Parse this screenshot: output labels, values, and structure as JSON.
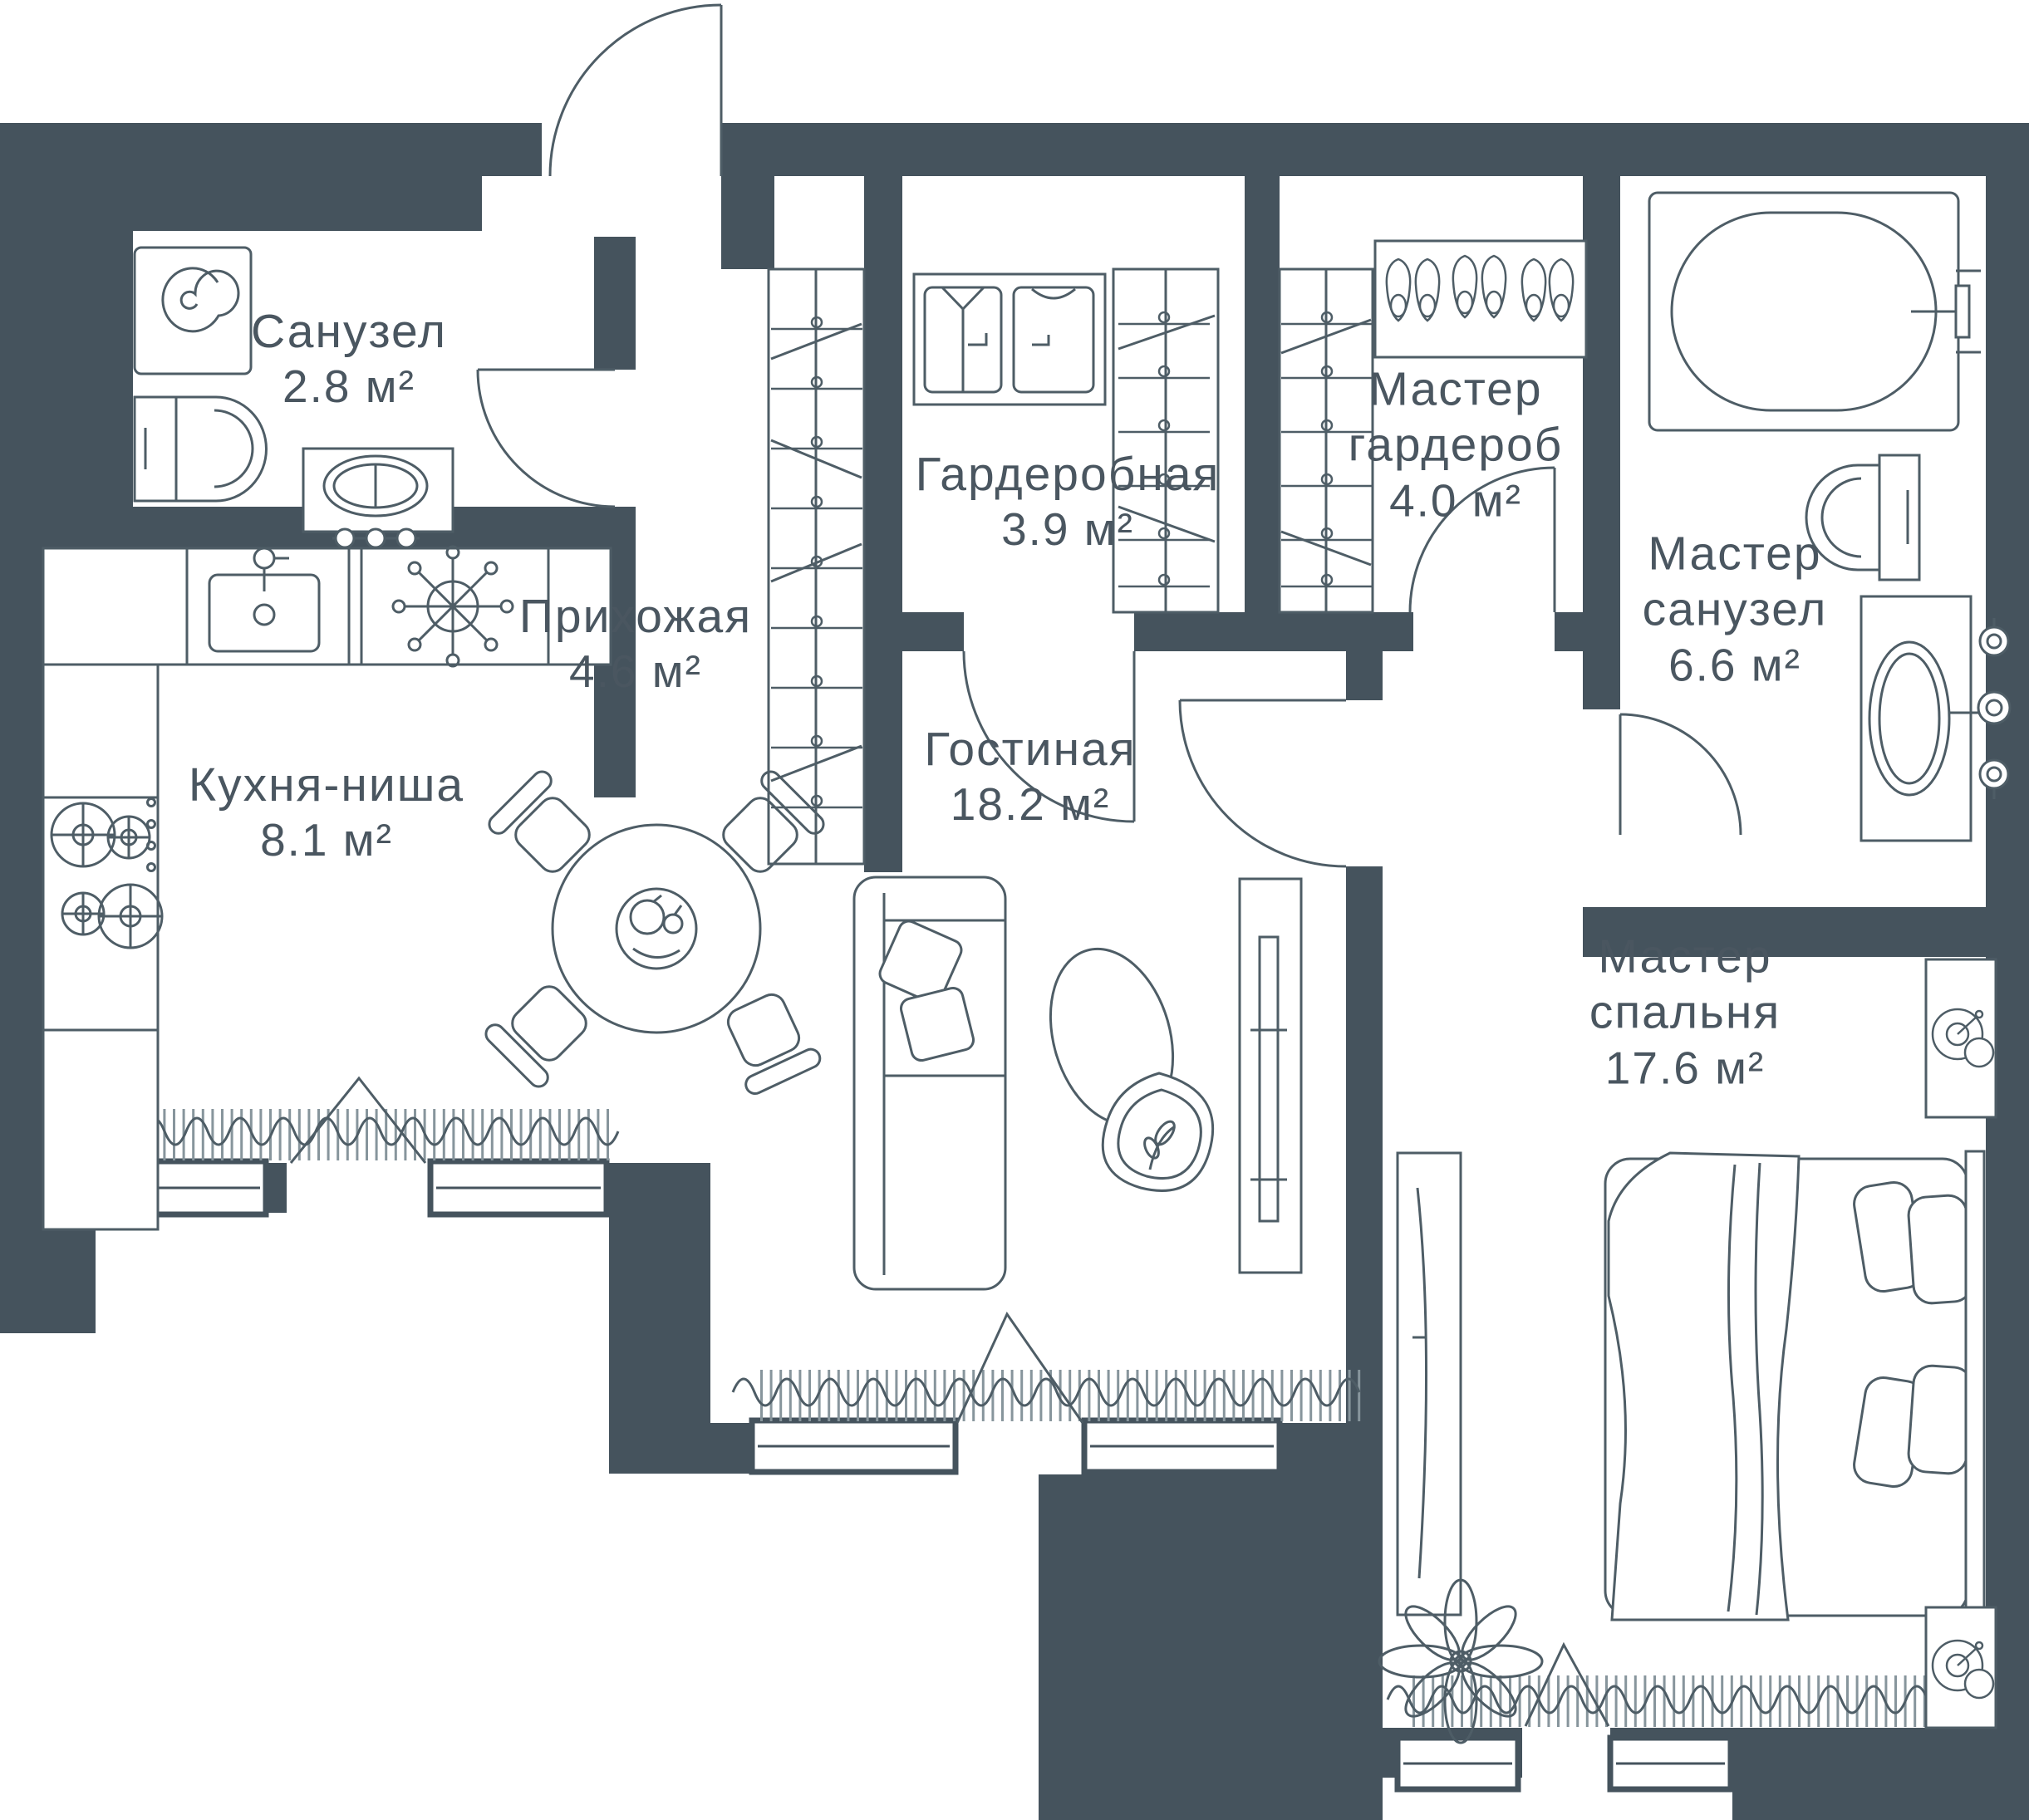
{
  "plan_type": "apartment floor plan",
  "rooms": [
    {
      "name": "Санузел",
      "area": "2.8 м²"
    },
    {
      "name": "Прихожая",
      "area": "4.6 м²"
    },
    {
      "name": "Гардеробная",
      "area": "3.9 м²"
    },
    {
      "name": "Мастер гардероб",
      "area": "4.0 м²"
    },
    {
      "name": "Мастер санузел",
      "area": "6.6 м²"
    },
    {
      "name": "Кухня-ниша",
      "area": "8.1 м²"
    },
    {
      "name": "Гостиная",
      "area": "18.2 м²"
    },
    {
      "name": "Мастер спальня",
      "area": "17.6 м²"
    }
  ],
  "colors": {
    "wall": "#45535d",
    "line": "#4e5d66",
    "hatch": "#87959c",
    "background": "#ffffff",
    "label": "#4a5660"
  }
}
